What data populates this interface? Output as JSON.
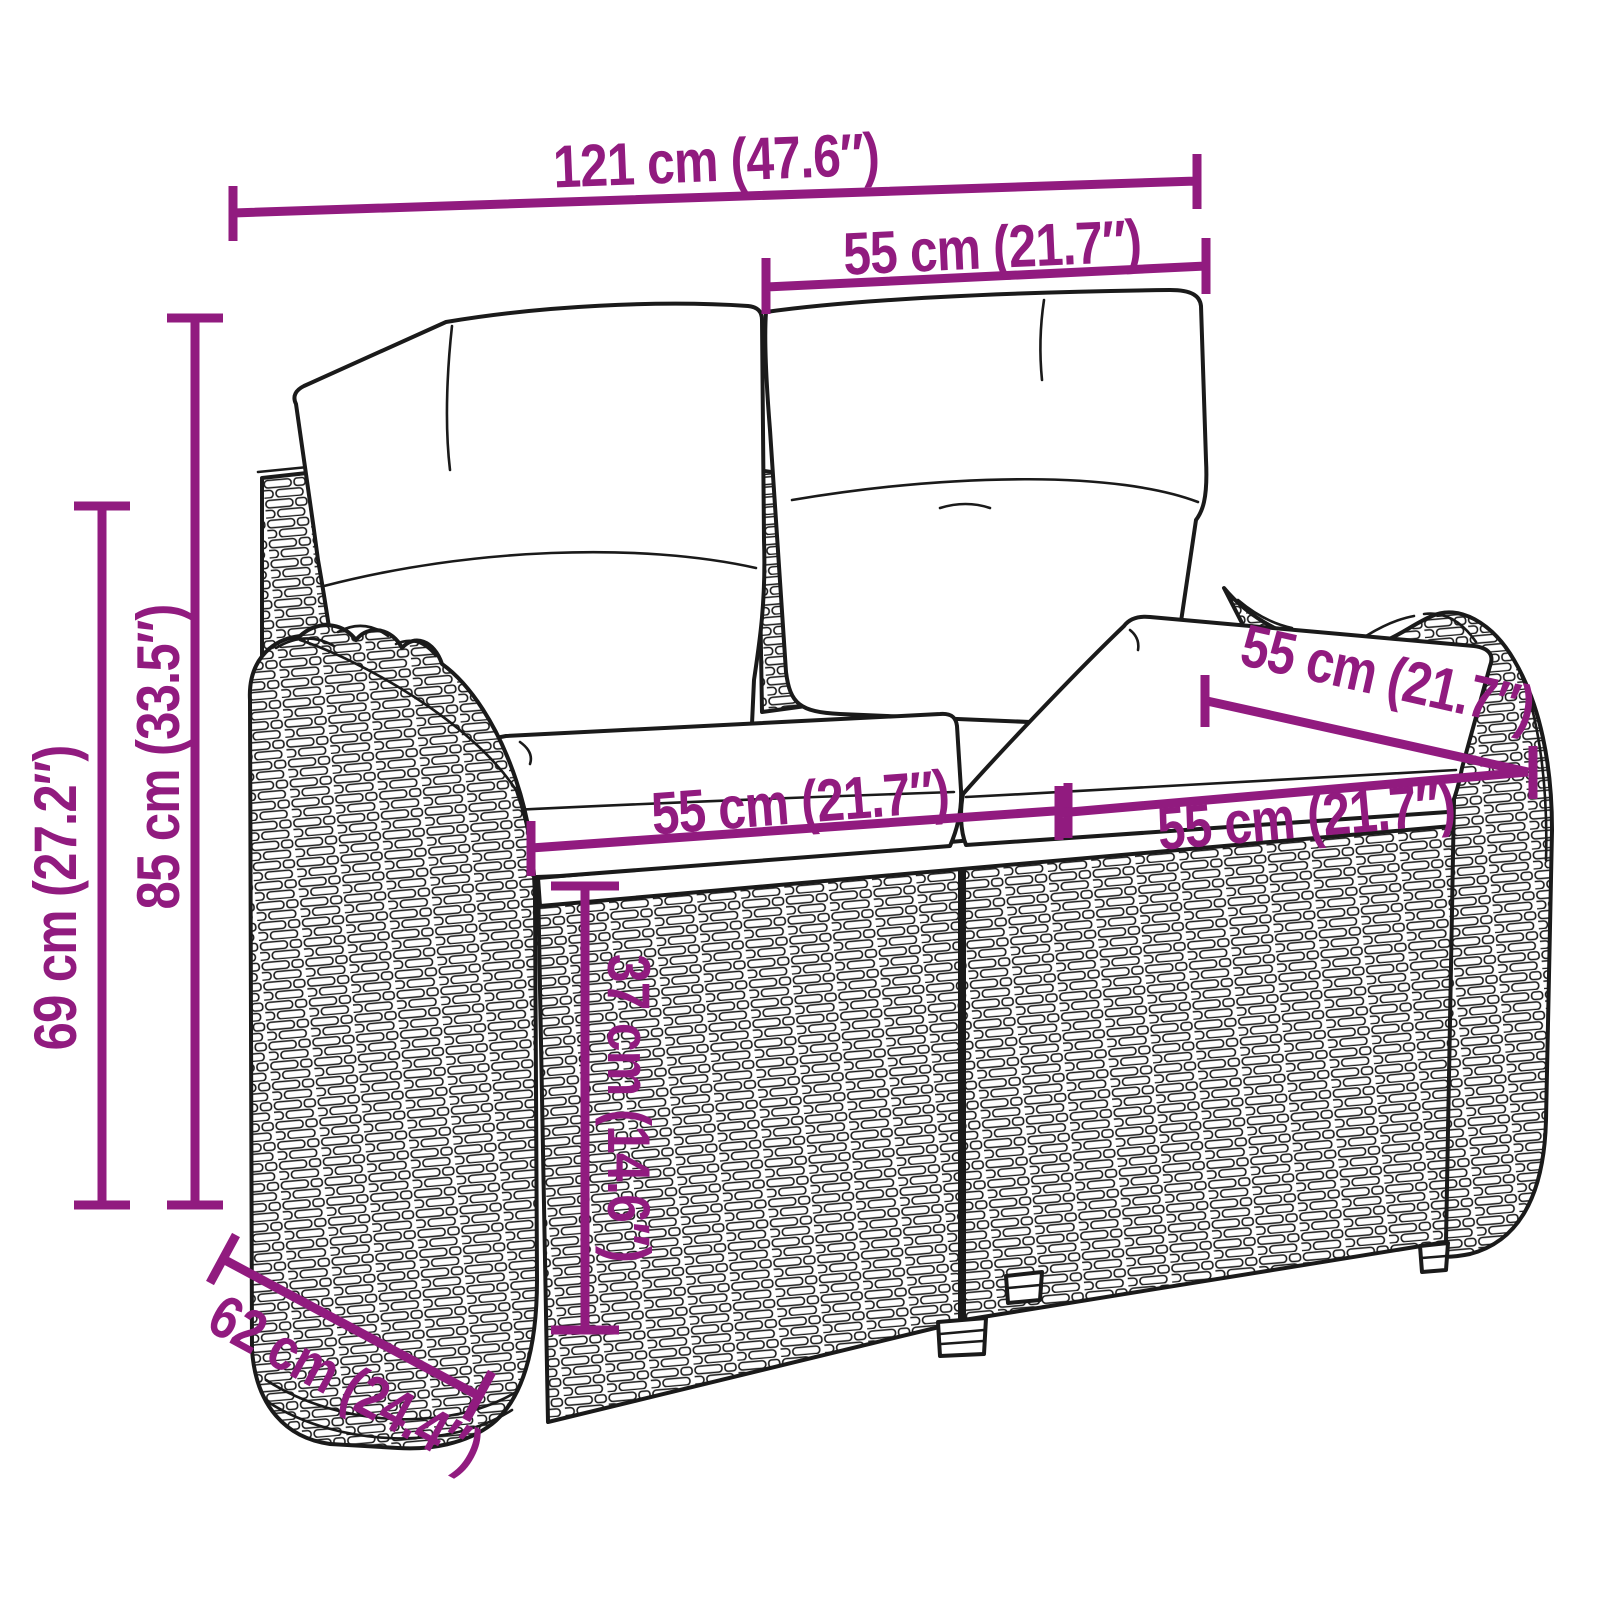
{
  "colors": {
    "accent": "#911b7f",
    "ink": "#1a1a1a",
    "background": "#ffffff",
    "cushion": "#ffffff"
  },
  "figure": {
    "subject": "rattan-garden-bench-with-cushions-line-art"
  },
  "dimensions": {
    "total_width": {
      "label": "121 cm (47.6″)"
    },
    "back_cushion_width": {
      "label": "55 cm (21.7″)"
    },
    "total_height": {
      "label": "85 cm (33.5″)"
    },
    "armrest_height": {
      "label": "69 cm (27.2″)"
    },
    "seat_depth": {
      "label": "55 cm (21.7″)"
    },
    "seat_width_left": {
      "label": "55 cm (21.7″)"
    },
    "seat_width_right": {
      "label": "55 cm (21.7″)"
    },
    "seat_height": {
      "label": "37 cm (14.6″)"
    },
    "total_depth": {
      "label": "62 cm (24.4″)"
    }
  }
}
